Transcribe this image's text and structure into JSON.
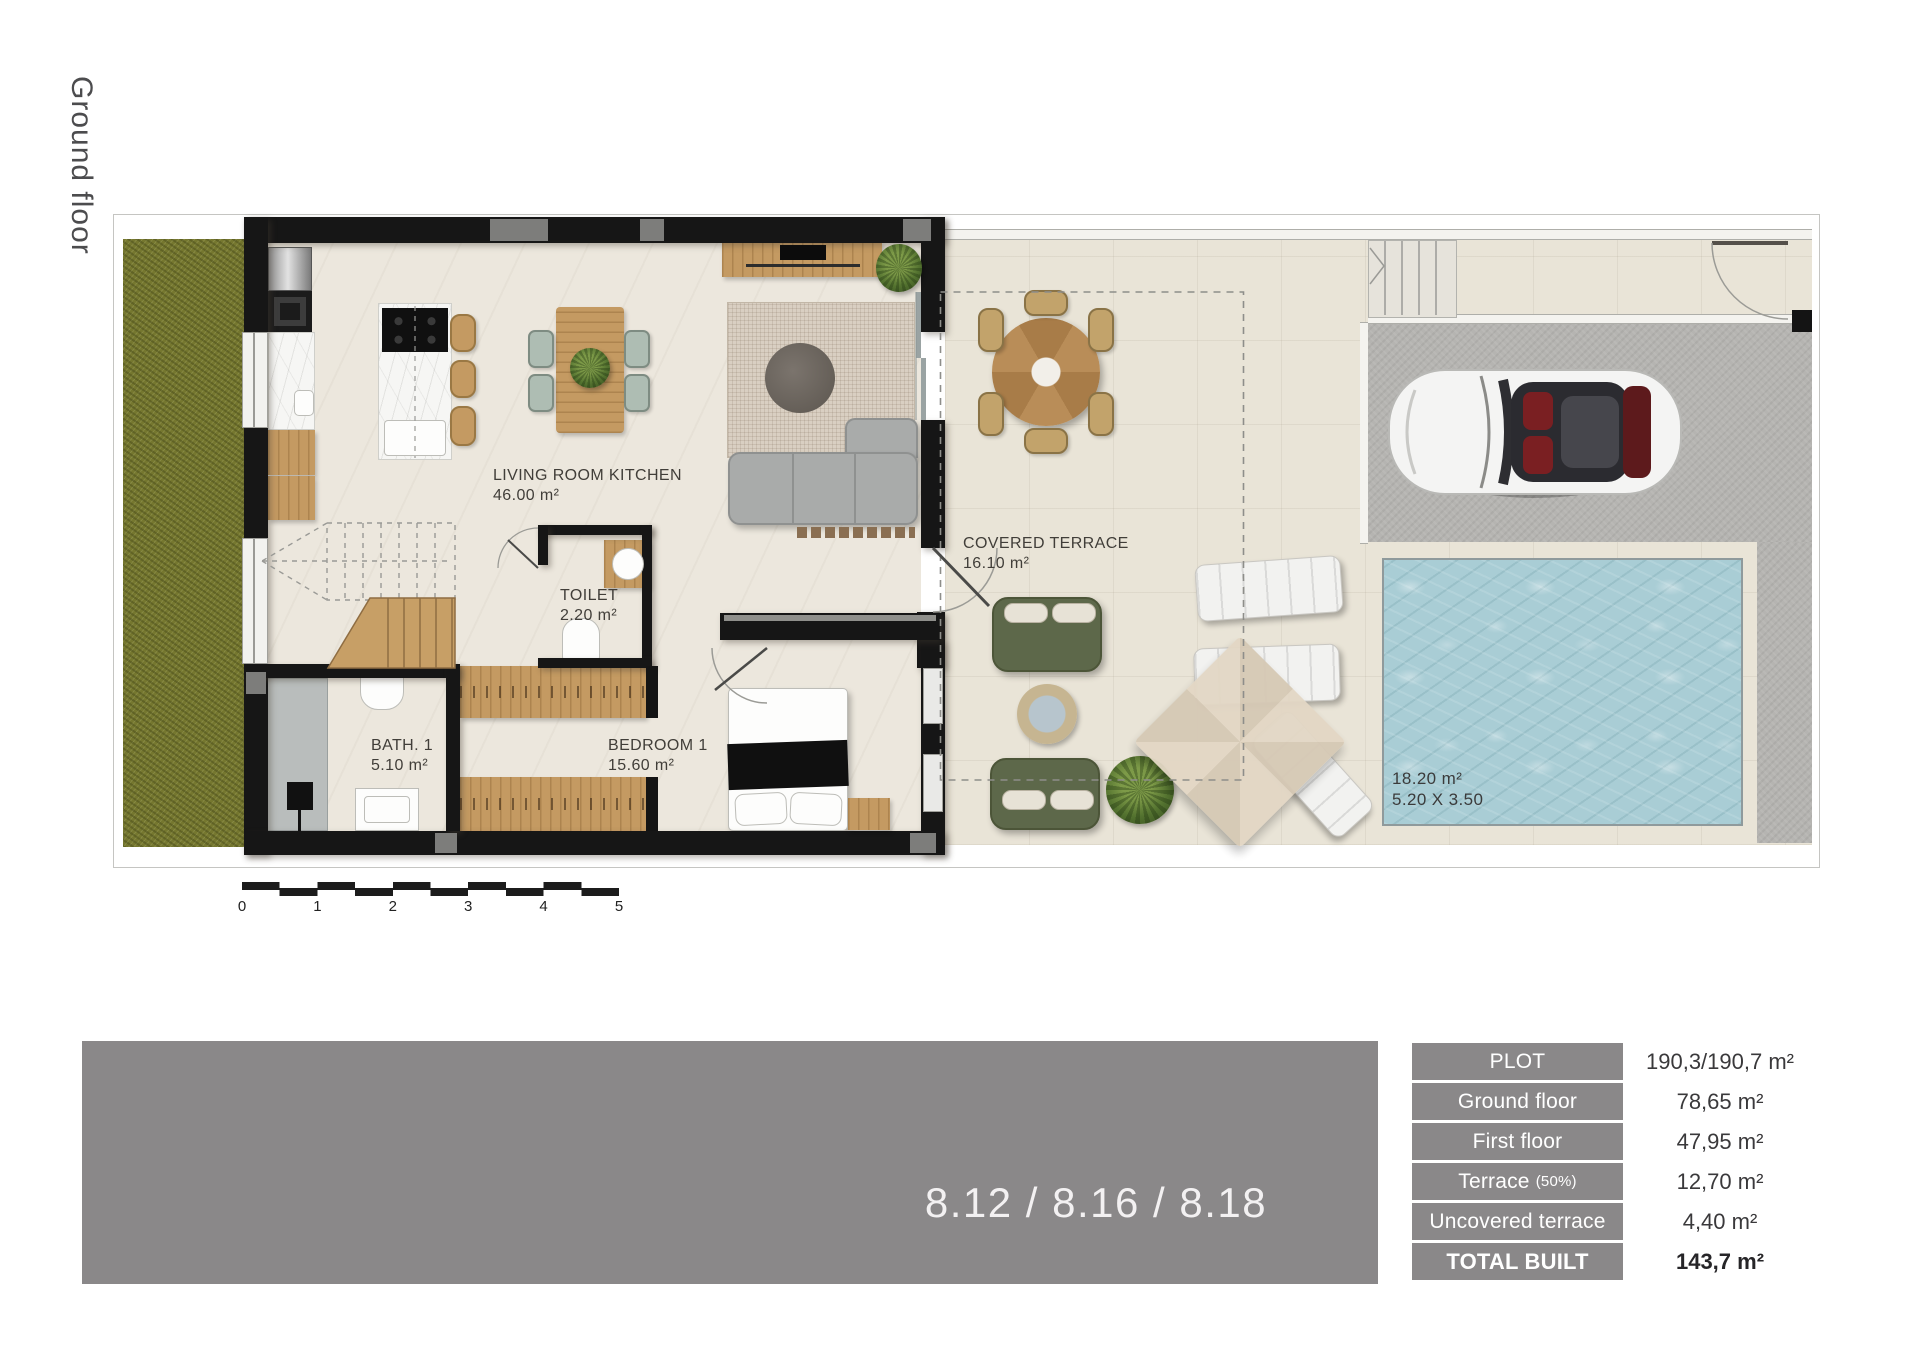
{
  "page": {
    "floor_label": "Ground floor",
    "banner_text": "8.12 / 8.16 / 8.18"
  },
  "rooms": {
    "living_room_kitchen": {
      "name": "LIVING ROOM KITCHEN",
      "area": "46.00 m²"
    },
    "toilet": {
      "name": "TOILET",
      "area": "2.20 m²"
    },
    "bath_1": {
      "name": "BATH. 1",
      "area": "5.10 m²"
    },
    "bedroom_1": {
      "name": "BEDROOM 1",
      "area": "15.60 m²"
    },
    "covered_terrace": {
      "name": "COVERED TERRACE",
      "area": "16.10 m²"
    },
    "pool": {
      "area": "18.20 m²",
      "dimensions": "5.20 X 3.50"
    }
  },
  "scale_bar": {
    "ticks": [
      "0",
      "1",
      "2",
      "3",
      "4",
      "5"
    ]
  },
  "summary_table": {
    "rows": [
      {
        "label": "PLOT",
        "value": "190,3/190,7 m²"
      },
      {
        "label": "Ground floor",
        "value": "78,65 m²"
      },
      {
        "label": "First floor",
        "value": "47,95 m²"
      },
      {
        "label": "Terrace",
        "label_suffix": "(50%)",
        "value": "12,70 m²"
      },
      {
        "label": "Uncovered terrace",
        "value": "4,40 m²"
      },
      {
        "label": "TOTAL BUILT",
        "value": "143,7 m²"
      }
    ]
  },
  "colors": {
    "panel_gray": "#8A8889",
    "wall_black": "#161616",
    "grass_green": "#75772F",
    "pool_water": "#A9CDD5",
    "driveway_gray": "#B5B4B1",
    "interior_floor": "#ECE7DD",
    "terrace_floor": "#E9E4D7",
    "wood": "#C49A62",
    "sofa_gray": "#A9ABAA",
    "outdoor_sofa_green": "#5D684A"
  }
}
